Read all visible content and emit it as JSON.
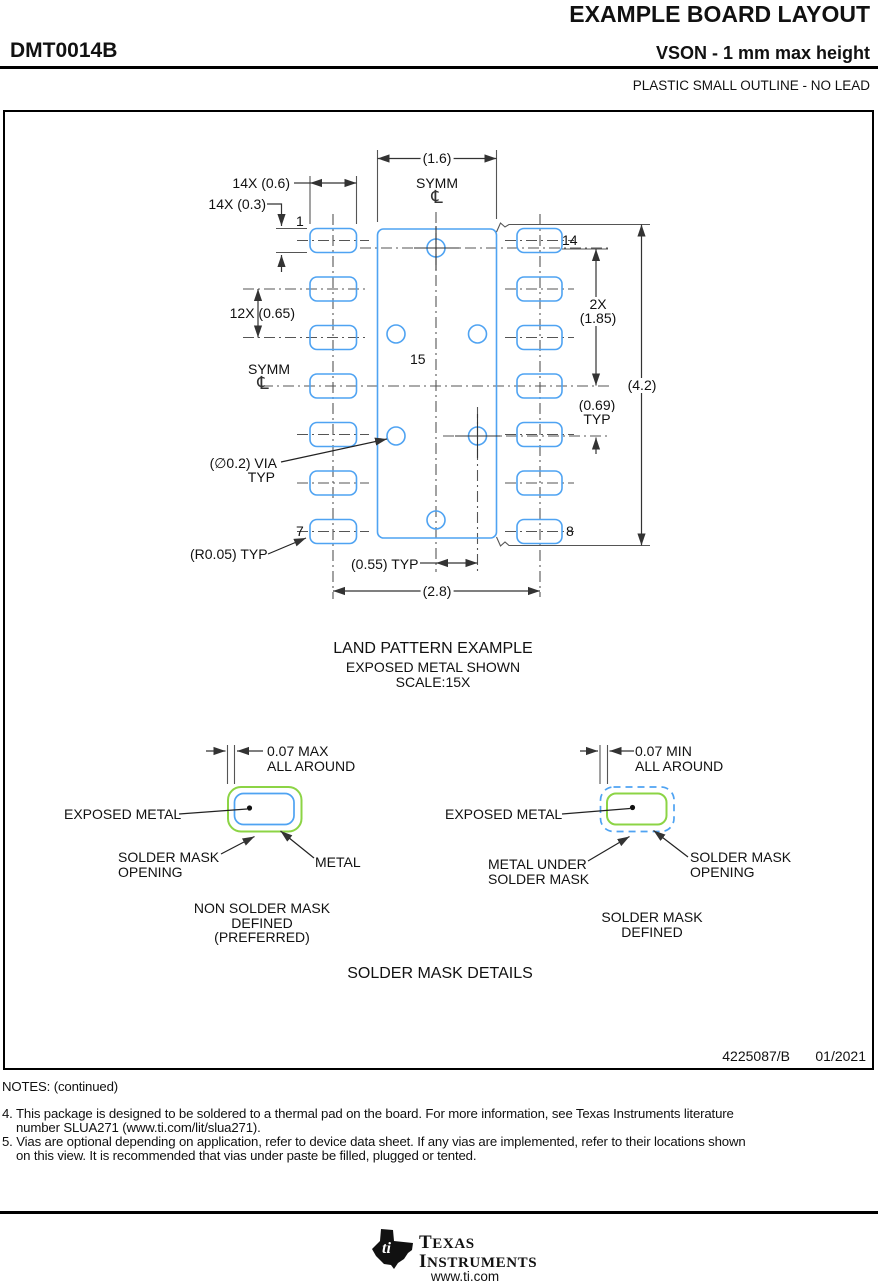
{
  "header": {
    "title": "EXAMPLE BOARD LAYOUT",
    "part_number": "DMT0014B",
    "subtitle": "VSON - 1 mm max height",
    "package_type": "PLASTIC SMALL OUTLINE - NO LEAD"
  },
  "drawing": {
    "dim_pad_span": "(1.6)",
    "symm": "SYMM",
    "centerline_symbol": "℄",
    "dim_14x_width": "14X (0.6)",
    "dim_14x_height": "14X (0.3)",
    "pin1": "1",
    "pin14": "14",
    "dim_pitch": "12X (0.65)",
    "pin15": "15",
    "dim_2x": "2X",
    "dim_1_85": "(1.85)",
    "dim_4_2": "(4.2)",
    "dim_0_69": "(0.69)",
    "typ": "TYP",
    "via_label": "(∅0.2) VIA",
    "pin7": "7",
    "pin8": "8",
    "dim_r0_05": "(R0.05) TYP",
    "dim_0_55": "(0.55) TYP",
    "dim_2_8": "(2.8)",
    "caption_line1": "LAND PATTERN EXAMPLE",
    "caption_line2": "EXPOSED METAL SHOWN",
    "caption_line3": "SCALE:15X"
  },
  "mask_details": {
    "left": {
      "dim_line1": "0.07 MAX",
      "dim_line2": "ALL AROUND",
      "exposed_metal": "EXPOSED METAL",
      "opening_line1": "SOLDER MASK",
      "opening_line2": "OPENING",
      "metal": "METAL",
      "caption_line1": "NON SOLDER MASK",
      "caption_line2": "DEFINED",
      "caption_line3": "(PREFERRED)"
    },
    "right": {
      "dim_line1": "0.07 MIN",
      "dim_line2": "ALL AROUND",
      "exposed_metal": "EXPOSED METAL",
      "metal_line1": "METAL UNDER",
      "metal_line2": "SOLDER MASK",
      "opening_line1": "SOLDER MASK",
      "opening_line2": "OPENING",
      "caption_line1": "SOLDER MASK",
      "caption_line2": "DEFINED"
    },
    "title": "SOLDER MASK DETAILS"
  },
  "doc": {
    "number": "4225087/B",
    "date": "01/2021"
  },
  "notes": {
    "heading": "NOTES: (continued)",
    "note4_line1": "4. This package is designed to be soldered to a thermal pad on the board. For more information, see Texas Instruments literature",
    "note4_line2": "number SLUA271 (www.ti.com/lit/slua271).",
    "note5_line1": "5. Vias are optional depending on application, refer to device data sheet. If any vias are implemented, refer to their locations shown",
    "note5_line2": "on this view. It is recommended that vias under paste be filled, plugged or tented."
  },
  "footer": {
    "brand_word1": "TEXAS",
    "brand_word2": "INSTRUMENTS",
    "logo_monogram": "ti",
    "website": "www.ti.com"
  },
  "colors": {
    "pad_blue": "#4FA3F2",
    "mask_green": "#8CD445",
    "line_gray": "#4d4d4d"
  }
}
